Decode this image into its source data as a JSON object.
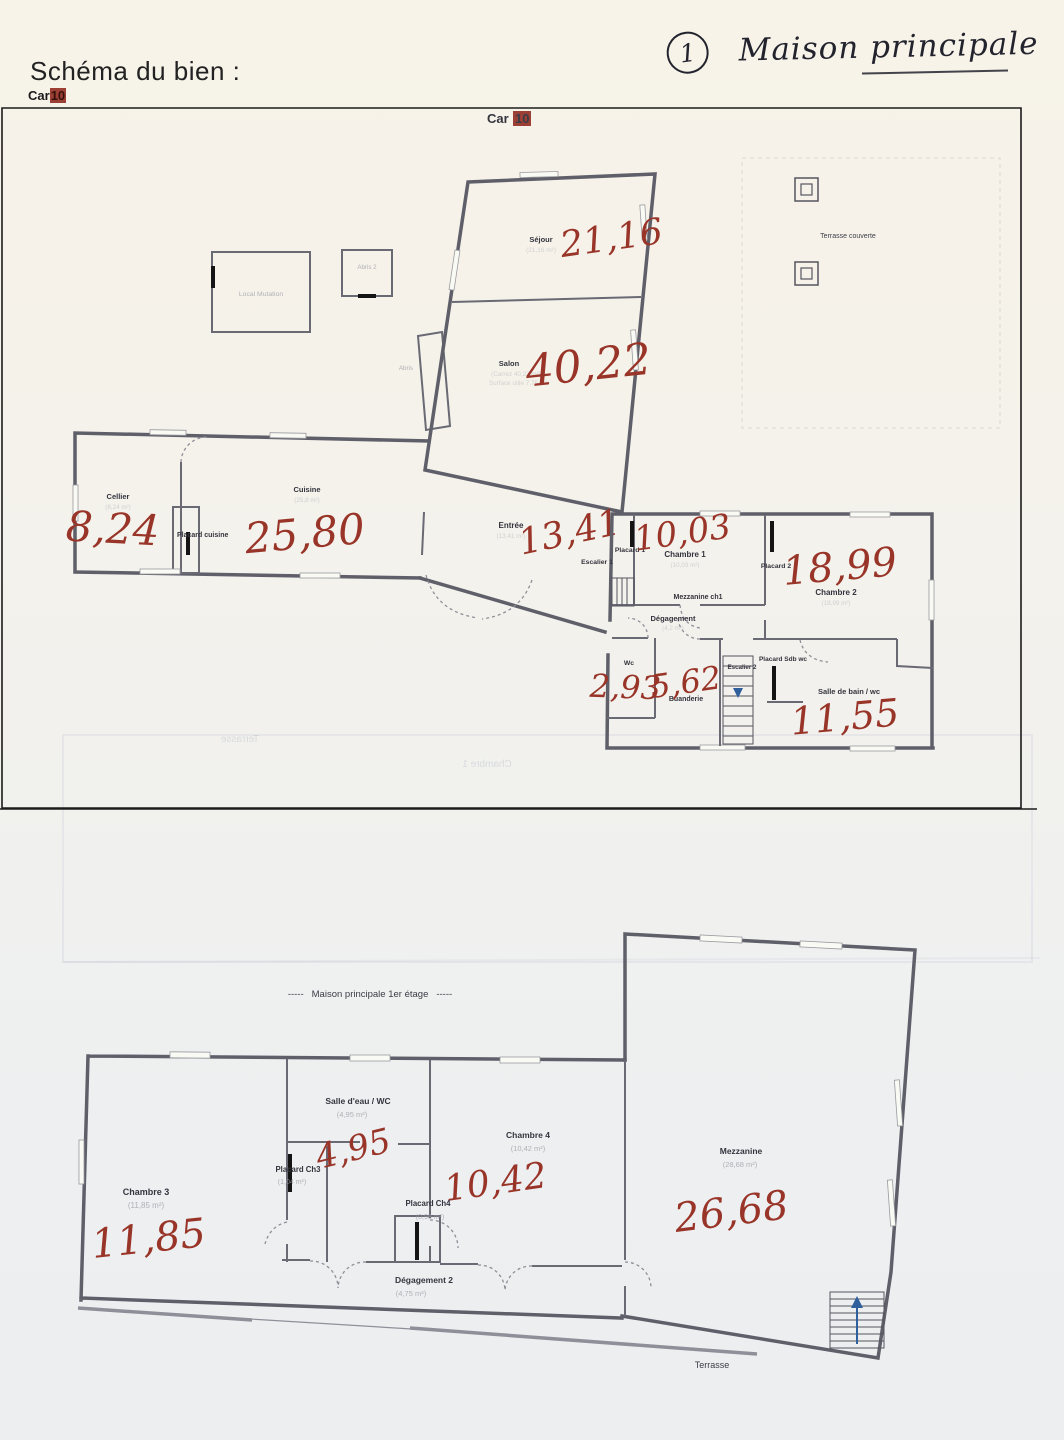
{
  "page": {
    "title": "Schéma du bien :",
    "code_prefix": "Car",
    "code_number": "10",
    "note": {
      "number": "1",
      "text": "Maison principale"
    }
  },
  "plan1": {
    "header_prefix": "Car",
    "header_number": "10",
    "outbuildings": {
      "local": "Local Mutation",
      "abris2": "Abris 2",
      "abris": "Abris"
    },
    "terrasse_couverte": "Terrasse couverte",
    "rooms": {
      "sejour": {
        "label": "Séjour",
        "area": "(21,16 m²)",
        "hand": "21,16"
      },
      "salon": {
        "label": "Salon",
        "area": "(Carrez 40,22 m²)",
        "area2": "Surface utile 7,75 m²",
        "hand": "40,22"
      },
      "cellier": {
        "label": "Cellier",
        "area": "(8,24 m²)",
        "hand": "8,24"
      },
      "placard_cuisine": {
        "label": "Placard cuisine"
      },
      "cuisine": {
        "label": "Cuisine",
        "area": "(25,8 m²)",
        "hand": "25,80"
      },
      "entree": {
        "label": "Entrée",
        "area": "(13,41 m²)",
        "hand": "13,41"
      },
      "placard1": {
        "label": "Placard 1"
      },
      "escalier1": {
        "label": "Escalier 1"
      },
      "chambre1": {
        "label": "Chambre 1",
        "area": "(10,03 m²)",
        "hand": "10,03"
      },
      "mezzanine_ch1": {
        "label": "Mezzanine ch1"
      },
      "placard2": {
        "label": "Placard 2"
      },
      "chambre2": {
        "label": "Chambre 2",
        "area": "(18,99 m²)",
        "hand": "18,99"
      },
      "degagement": {
        "label": "Dégagement",
        "area": "(4,2 m²)"
      },
      "wc": {
        "label": "Wc",
        "hand": "2,93"
      },
      "buanderie": {
        "label": "Buanderie",
        "hand": "5,62"
      },
      "escalier2": {
        "label": "Escalier 2"
      },
      "placard_sdb": {
        "label": "Placard Sdb wc"
      },
      "sdb": {
        "label": "Salle de bain / wc",
        "hand": "11,55"
      }
    },
    "ghosts": {
      "g1": "Terrasse",
      "g2": "Chambre 1"
    }
  },
  "plan2": {
    "caption": "Maison principale 1er étage",
    "caption_dashes": "-----",
    "rooms": {
      "chambre3": {
        "label": "Chambre 3",
        "area": "(11,85 m²)",
        "hand": "11,85"
      },
      "placard_ch3": {
        "label": "Placard Ch3",
        "area": "(1,04 m²)"
      },
      "salle_eau": {
        "label": "Salle d'eau / WC",
        "area": "(4,95 m²)",
        "hand": "4,95"
      },
      "chambre4": {
        "label": "Chambre 4",
        "area": "(10,42 m²)",
        "hand": "10,42"
      },
      "placard_ch4": {
        "label": "Placard Ch4",
        "area": "(0,98 m²)"
      },
      "mezzanine": {
        "label": "Mezzanine",
        "area": "(28,68 m²)",
        "hand": "26,68"
      },
      "degagement2": {
        "label": "Dégagement 2",
        "area": "(4,75 m²)"
      },
      "terrasse": {
        "label": "Terrasse"
      }
    }
  },
  "colors": {
    "hand_red": "#993428",
    "ink": "#23232e",
    "code_highlight_bg": "#9c4036",
    "wall": "#5f5f6a"
  }
}
